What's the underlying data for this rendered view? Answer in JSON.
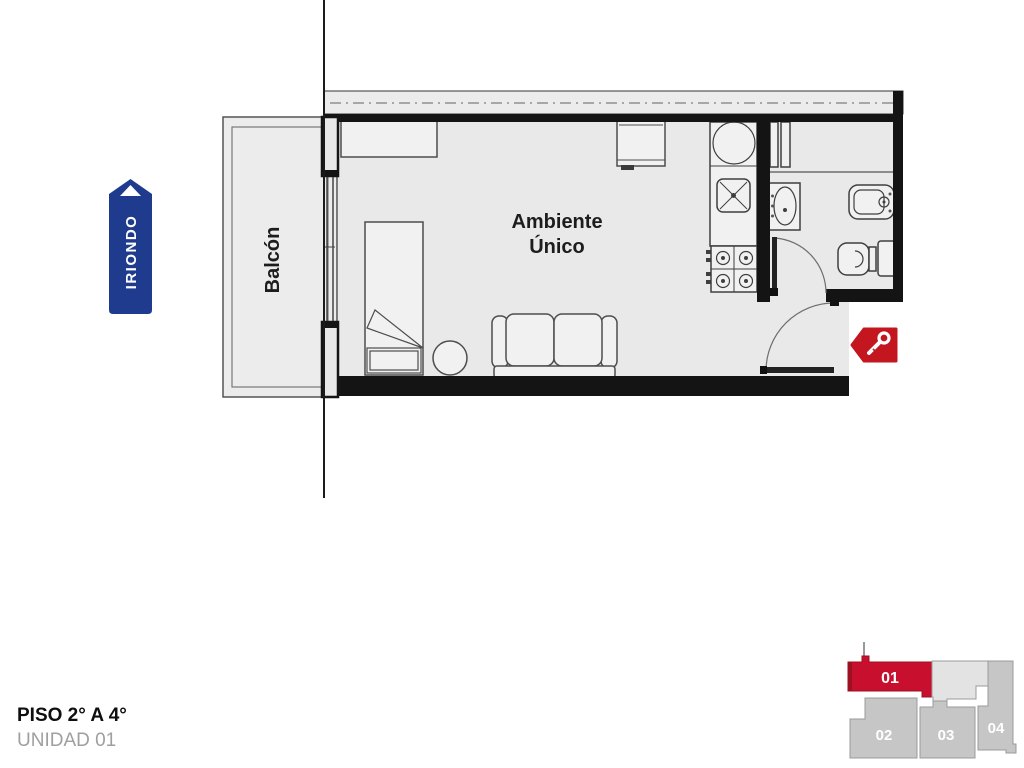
{
  "plan": {
    "room_label": {
      "line1": "Ambiente",
      "line2": "Único"
    },
    "balcony_label": "Balcón",
    "street_badge": {
      "label": "IRIONDO",
      "color": "#1e3b8e",
      "arrow": "up"
    },
    "entrance_tag": {
      "icon": "key",
      "color": "#c3161f"
    },
    "colors": {
      "wall": "#141414",
      "floor": "#e9e9e9",
      "party_wall_strip": "#ececec"
    }
  },
  "footer": {
    "floor_range": "PISO 2° A 4°",
    "unit": "UNIDAD 01"
  },
  "keyplan": {
    "selected_unit": "01",
    "highlight_color": "#c8102e",
    "unit_color": "#c6c6c6",
    "common_area_color": "#e3e3e3",
    "units": [
      {
        "id": "01",
        "highlighted": true
      },
      {
        "id": "02",
        "highlighted": false
      },
      {
        "id": "03",
        "highlighted": false
      },
      {
        "id": "04",
        "highlighted": false
      }
    ]
  }
}
